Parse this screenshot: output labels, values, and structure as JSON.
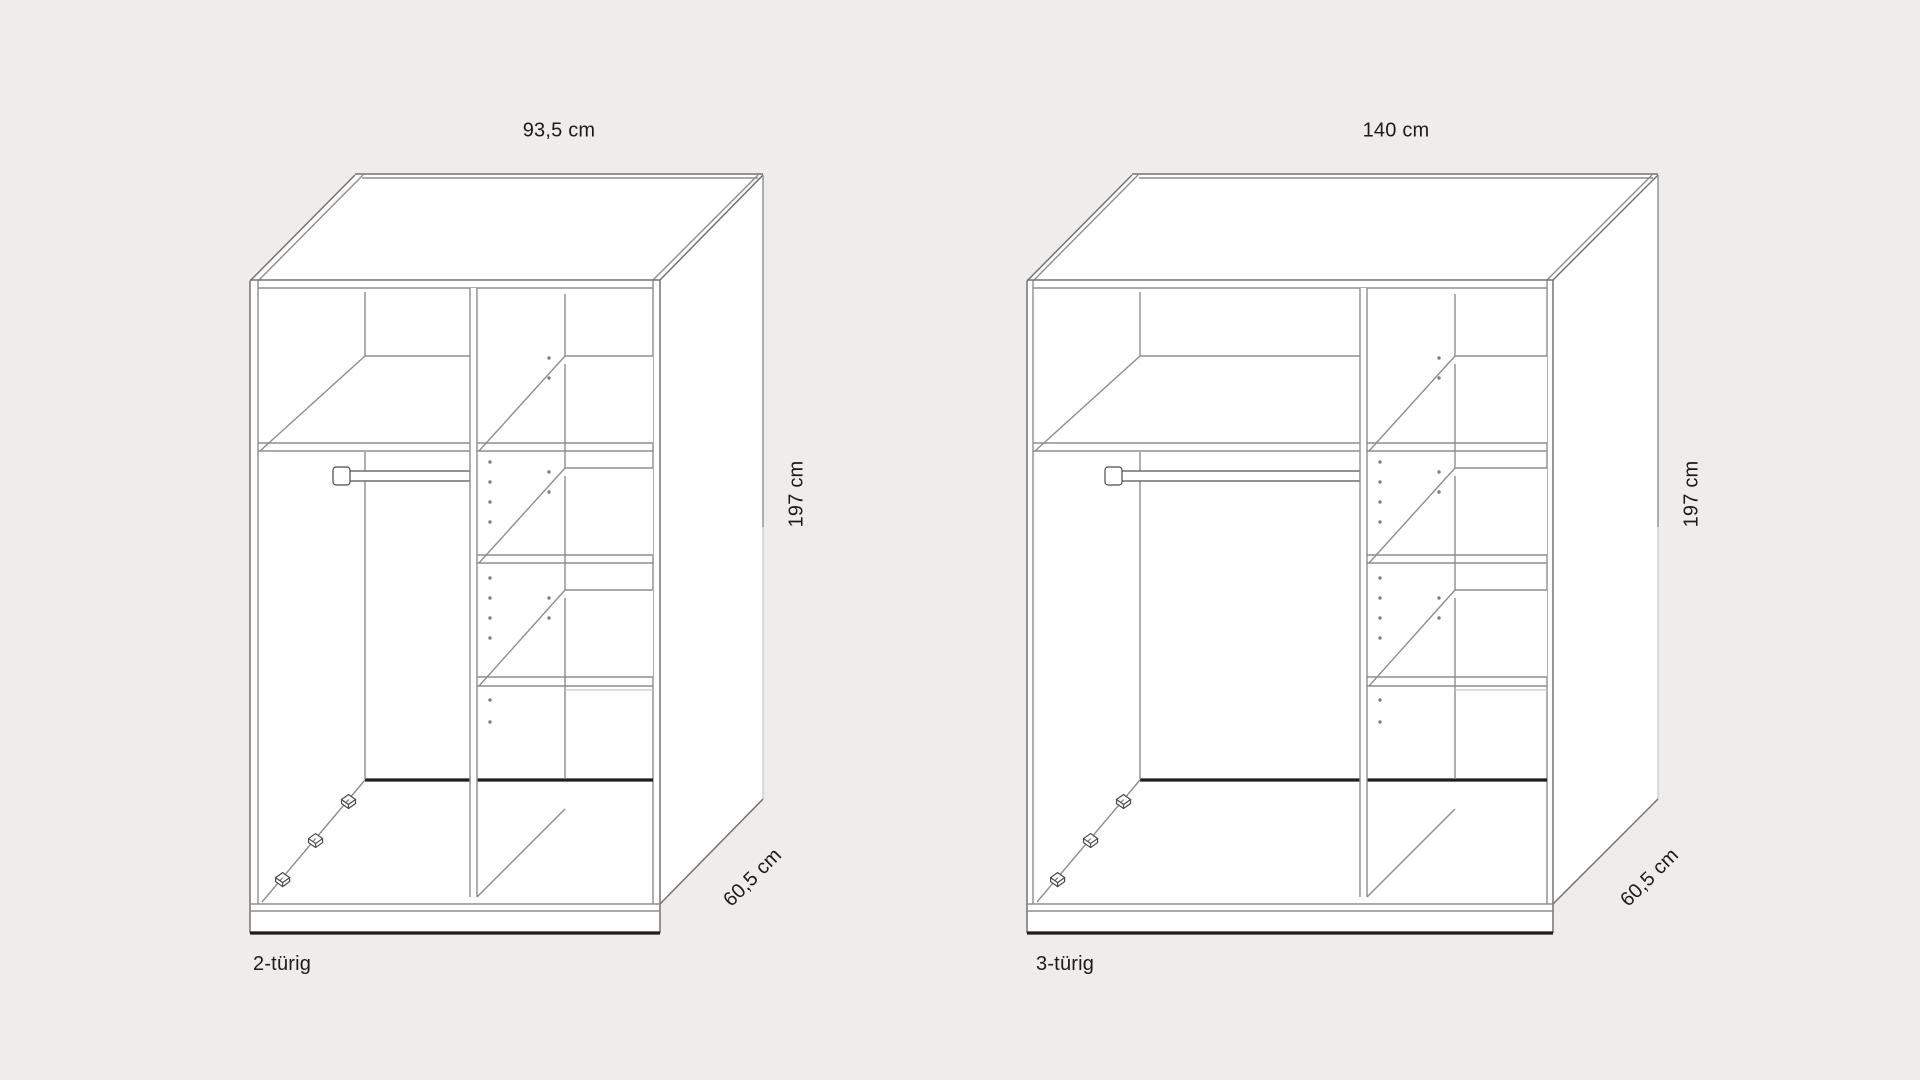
{
  "page": {
    "background_color": "#eeedeb",
    "drawing_line_color": "#8d8d8d",
    "dark_line_color": "#1e1e1e",
    "text_color": "#1b1b1b"
  },
  "figures": [
    {
      "name_label": "2-türig",
      "width_label": "93,5 cm",
      "height_label": "197 cm",
      "depth_label": "60,5 cm"
    },
    {
      "name_label": "3-türig",
      "width_label": "140 cm",
      "height_label": "197 cm",
      "depth_label": "60,5 cm"
    }
  ]
}
